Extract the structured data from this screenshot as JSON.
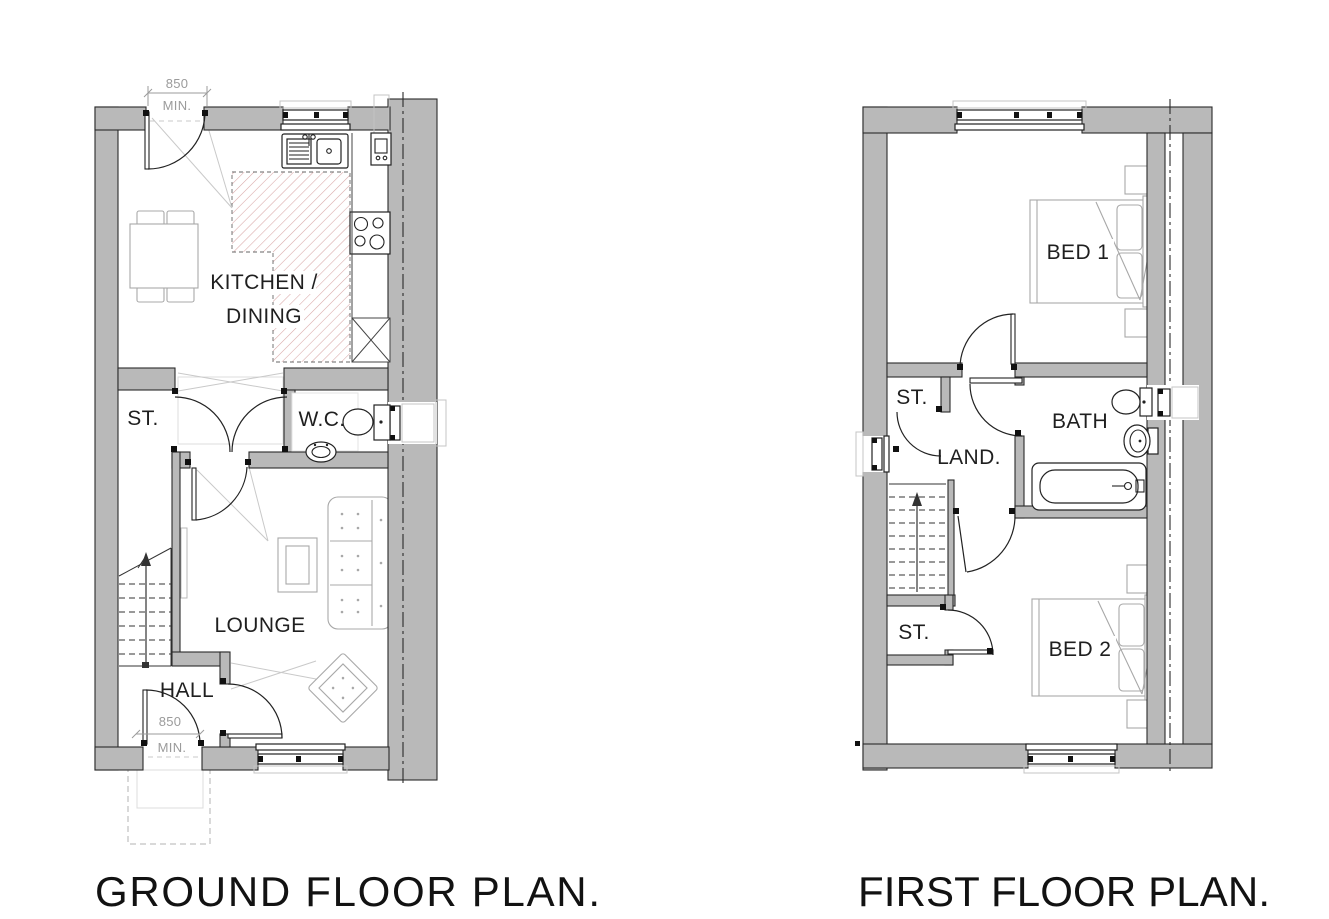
{
  "ground_floor": {
    "title": "GROUND FLOOR PLAN.",
    "labels": {
      "kitchen_line1": "KITCHEN /",
      "kitchen_line2": "DINING",
      "store": "ST.",
      "wc": "W.C.",
      "lounge": "LOUNGE",
      "hall": "HALL"
    },
    "dimensions": {
      "back_door": {
        "value": "850",
        "qualifier": "MIN."
      },
      "front_door": {
        "value": "850",
        "qualifier": "MIN."
      }
    }
  },
  "first_floor": {
    "title": "FIRST FLOOR PLAN.",
    "labels": {
      "bed1": "BED 1",
      "store_upper": "ST.",
      "landing": "LAND.",
      "bath": "BATH",
      "store_lower": "ST.",
      "bed2": "BED 2"
    }
  },
  "colors": {
    "wall_fill": "#b9b9b9",
    "line": "#222222",
    "furniture": "#a8a8a8",
    "kitchen_hatch": "#d8a6a6",
    "dimension_text": "#9b9b9b",
    "background": "#ffffff"
  }
}
